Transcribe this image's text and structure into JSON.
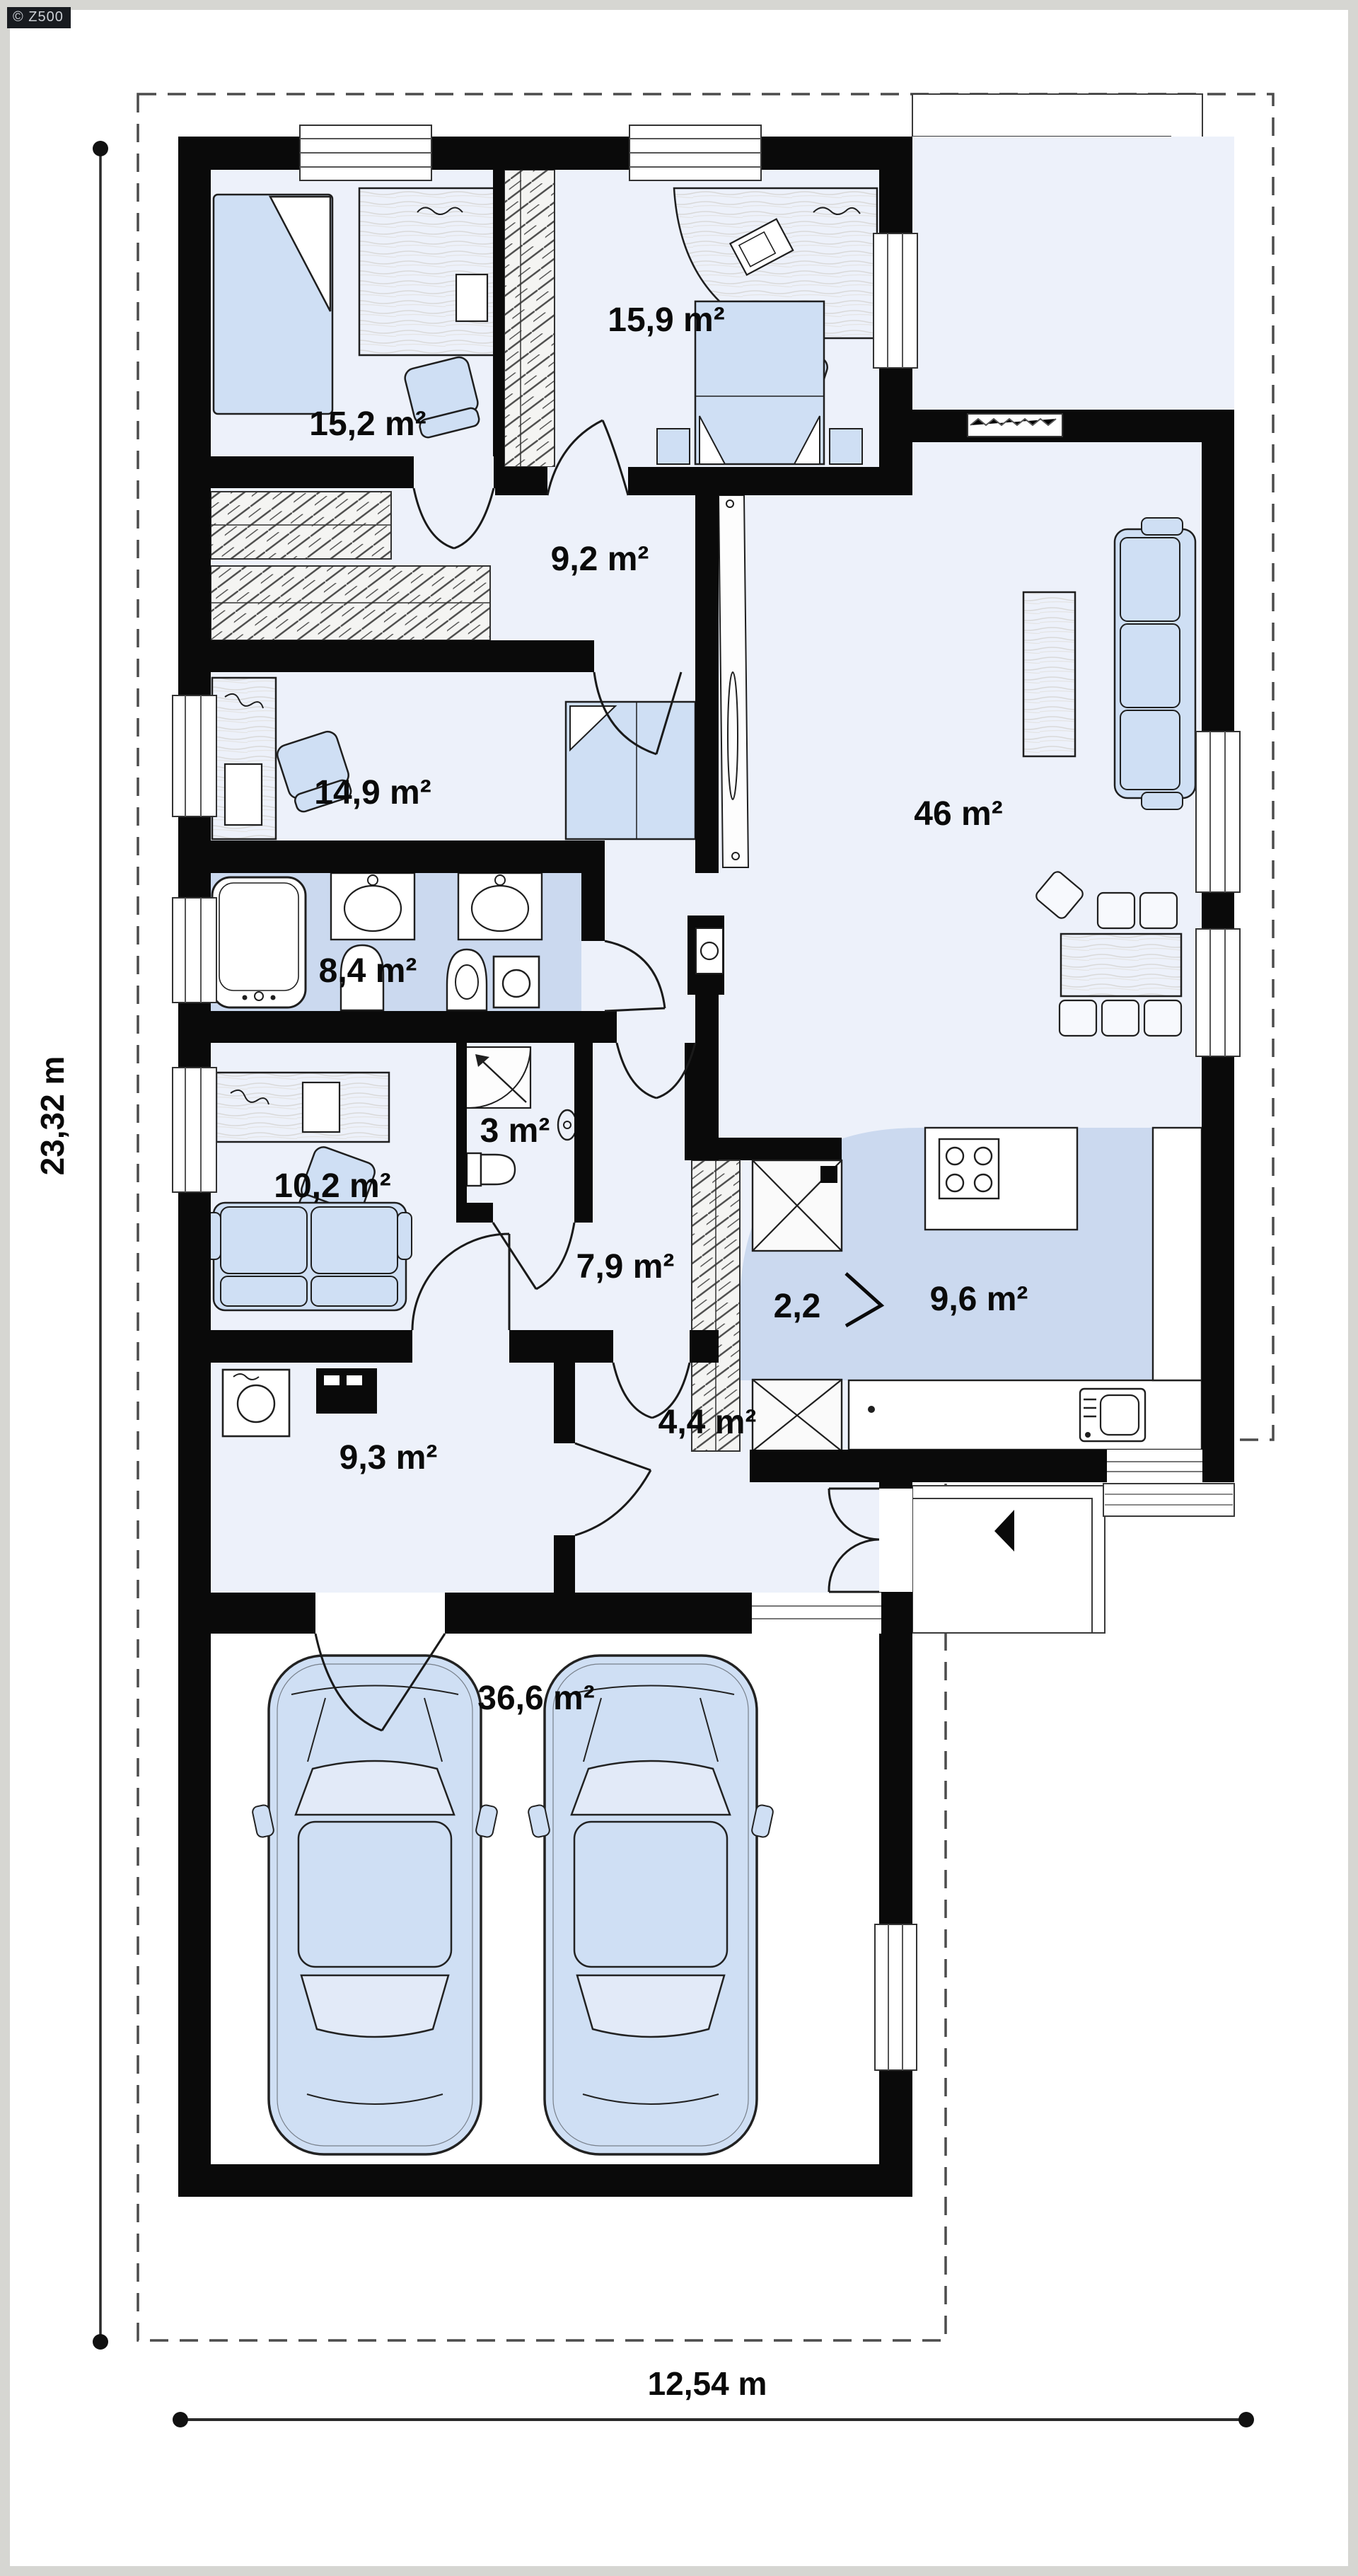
{
  "watermark": {
    "label": "© Z500"
  },
  "dimensions": {
    "height": "23,32 m",
    "width": "12,54 m"
  },
  "rooms": [
    {
      "name": "bedroom-left",
      "area": "15,2 m²"
    },
    {
      "name": "bedroom-top",
      "area": "15,9 m²"
    },
    {
      "name": "corridor",
      "area": "9,2 m²"
    },
    {
      "name": "bedroom-middle",
      "area": "14,9 m²"
    },
    {
      "name": "living-room",
      "area": "46 m²"
    },
    {
      "name": "bathroom",
      "area": "8,4 m²"
    },
    {
      "name": "wc",
      "area": "3 m²"
    },
    {
      "name": "office",
      "area": "10,2 m²"
    },
    {
      "name": "pantry",
      "area": "2,2"
    },
    {
      "name": "kitchen",
      "area": "9,6 m²"
    },
    {
      "name": "hall",
      "area": "7,9 m²"
    },
    {
      "name": "entry",
      "area": "4,4 m²"
    },
    {
      "name": "utility",
      "area": "9,3 m²"
    },
    {
      "name": "garage",
      "area": "36,6 m²"
    }
  ],
  "colors": {
    "wall": "#0a0a0a",
    "floor": "#edf1fa",
    "wet_floor": "#cbd9ef",
    "furniture": "#cfdff4",
    "paper": "#ffffff",
    "frame": "#d6d6d2",
    "dash_line": "#4c4c4c"
  }
}
